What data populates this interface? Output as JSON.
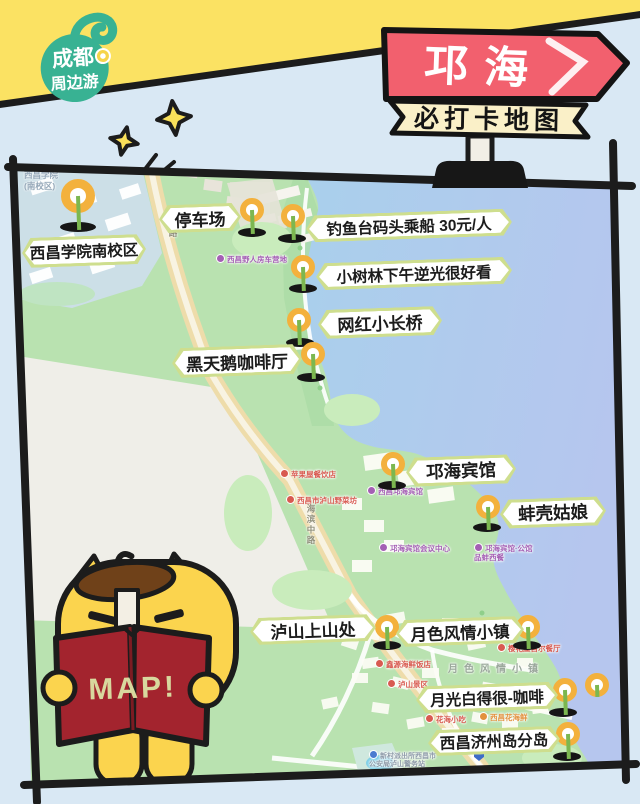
{
  "logo": {
    "line1": "成都",
    "line2": "周边游"
  },
  "sign": {
    "title": "邛海",
    "subtitle": "必打卡地图"
  },
  "mascot": {
    "book_text": "MAP!"
  },
  "map": {
    "spots": [
      {
        "label": "西昌学院南校区"
      },
      {
        "label": "停车场"
      },
      {
        "label": "钓鱼台码头乘船 30元/人"
      },
      {
        "label": "小树林下午逆光很好看"
      },
      {
        "label": "网红小长桥"
      },
      {
        "label": "黑天鹅咖啡厅"
      },
      {
        "label": "邛海宾馆"
      },
      {
        "label": "蚌壳姑娘"
      },
      {
        "label": "泸山上山处"
      },
      {
        "label": "月色风情小镇"
      },
      {
        "label": "月光白得很-咖啡"
      },
      {
        "label": "西昌济州岛分岛"
      }
    ],
    "poi": [
      {
        "text": "西昌野人房车营地",
        "type": "purple"
      },
      {
        "text": "苹果屋餐饮店",
        "type": "red"
      },
      {
        "text": "西昌市泸山野菜坊",
        "type": "red"
      },
      {
        "text": "西昌邛海宾馆",
        "type": "purple"
      },
      {
        "text": "邛海宾馆会议中心",
        "type": "purple"
      },
      {
        "text": "邛海宾馆·公馆",
        "type": "purple"
      },
      {
        "text": "品蚌西餐",
        "type": "purple"
      },
      {
        "text": "鑫源海鲜饭店",
        "type": "red"
      },
      {
        "text": "泸山景区",
        "type": "red"
      },
      {
        "text": "樱花屋首尔餐厅",
        "type": "red"
      },
      {
        "text": "花海小吃",
        "type": "red"
      },
      {
        "text": "西昌花海鲜",
        "type": "orange"
      },
      {
        "text": "新村派出所西昌市",
        "type": "grey"
      },
      {
        "text": "公安局泸山警务站",
        "type": "grey"
      }
    ],
    "area_labels": {
      "campus_line1": "西昌学院",
      "campus_line2": "(南校区)",
      "village": "月色风情小镇"
    },
    "road_labels": {
      "r1": "中路",
      "r2": "海滨中路"
    }
  },
  "colors": {
    "banner_yellow": "#fbe263",
    "sign_red": "#f2606e",
    "ribbon_cream": "#faf0c8",
    "logo_green": "#38b293",
    "pin_orange": "#f3b13d",
    "pin_stem_green": "#7cb750",
    "label_border_green": "#cede8e",
    "land_green": "#b9e2b0",
    "water_blue": "#aed2ec",
    "road_tan": "#eedcaa",
    "book_red": "#a3242e",
    "mascot_yellow": "#fbd44e",
    "hat_brown": "#6f4119",
    "frame_black": "#1c1c1c"
  }
}
